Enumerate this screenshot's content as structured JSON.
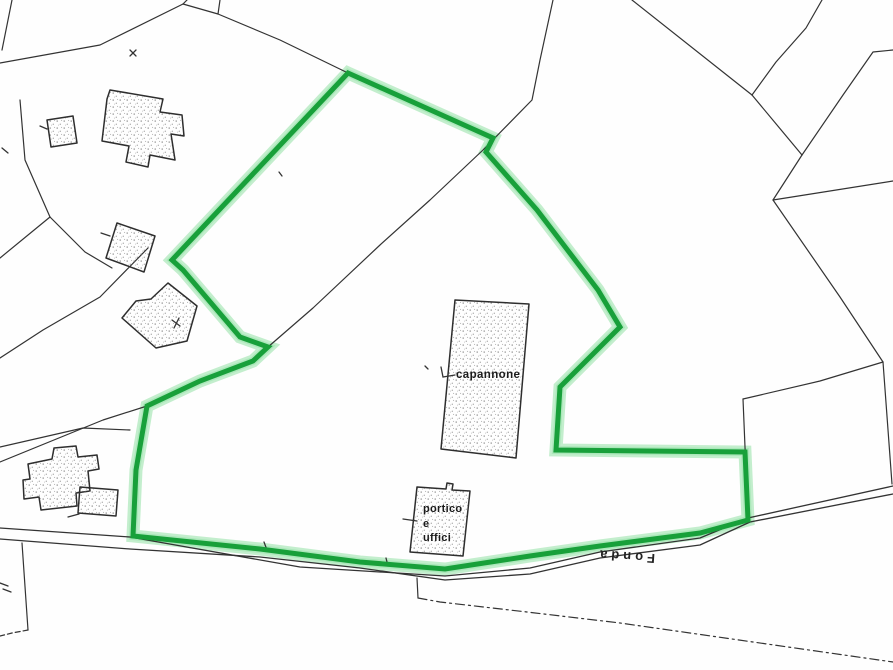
{
  "map": {
    "type": "cadastral-plan",
    "background": "#fefefe",
    "colors": {
      "highlight_green": "#18a03a",
      "highlight_glow": "#bcecc8",
      "highlight_glow_mid": "#8fdfa4",
      "parcel_line": "#333333",
      "building_outline": "#2e2e2e",
      "stipple_dot": "#777777"
    },
    "labels": {
      "capannone": {
        "text": "capannone",
        "x": 457,
        "y": 372
      },
      "portico": {
        "lines": [
          "portico",
          "e",
          "uffici"
        ],
        "x": 424,
        "y": 505
      },
      "fonda": {
        "text": "Fonda",
        "x": 624,
        "y": 560,
        "rotation_deg": 184
      }
    },
    "highlight_boundary": {
      "closed": true,
      "points": [
        [
          348,
          73
        ],
        [
          493,
          138
        ],
        [
          486,
          152
        ],
        [
          537,
          210
        ],
        [
          598,
          290
        ],
        [
          620,
          327
        ],
        [
          560,
          387
        ],
        [
          556,
          450
        ],
        [
          745,
          452
        ],
        [
          748,
          520
        ],
        [
          700,
          533
        ],
        [
          600,
          546
        ],
        [
          530,
          556
        ],
        [
          445,
          569
        ],
        [
          360,
          562
        ],
        [
          260,
          549
        ],
        [
          133,
          536
        ],
        [
          136,
          470
        ],
        [
          147,
          406
        ],
        [
          200,
          381
        ],
        [
          253,
          361
        ],
        [
          268,
          347
        ],
        [
          240,
          337
        ],
        [
          183,
          270
        ],
        [
          172,
          260
        ]
      ]
    },
    "parcel_lines": [
      {
        "pts": [
          [
            12,
            0
          ],
          [
            2,
            50
          ]
        ]
      },
      {
        "pts": [
          [
            187,
            0
          ],
          [
            183,
            4
          ]
        ]
      },
      {
        "pts": [
          [
            183,
            4
          ],
          [
            100,
            45
          ],
          [
            0,
            63
          ]
        ]
      },
      {
        "pts": [
          [
            220,
            0
          ],
          [
            218,
            14
          ]
        ]
      },
      {
        "pts": [
          [
            183,
            4
          ],
          [
            218,
            14
          ],
          [
            280,
            40
          ],
          [
            348,
            73
          ]
        ]
      },
      {
        "pts": [
          [
            553,
            0
          ],
          [
            540,
            60
          ],
          [
            532,
            100
          ],
          [
            483,
            150
          ],
          [
            430,
            200
          ],
          [
            380,
            245
          ],
          [
            313,
            308
          ],
          [
            268,
            347
          ]
        ]
      },
      {
        "pts": [
          [
            632,
            0
          ],
          [
            752,
            95
          ]
        ]
      },
      {
        "pts": [
          [
            822,
            0
          ],
          [
            806,
            28
          ],
          [
            776,
            62
          ],
          [
            752,
            95
          ]
        ]
      },
      {
        "pts": [
          [
            752,
            95
          ],
          [
            802,
            155
          ]
        ]
      },
      {
        "pts": [
          [
            893,
            50
          ],
          [
            873,
            52
          ],
          [
            843,
            95
          ],
          [
            802,
            155
          ]
        ]
      },
      {
        "pts": [
          [
            802,
            155
          ],
          [
            773,
            200
          ]
        ]
      },
      {
        "pts": [
          [
            773,
            200
          ],
          [
            893,
            181
          ]
        ]
      },
      {
        "pts": [
          [
            773,
            200
          ],
          [
            840,
            297
          ],
          [
            883,
            362
          ]
        ]
      },
      {
        "pts": [
          [
            883,
            362
          ],
          [
            892,
            484
          ]
        ]
      },
      {
        "pts": [
          [
            883,
            362
          ],
          [
            820,
            381
          ],
          [
            743,
            399
          ]
        ]
      },
      {
        "pts": [
          [
            743,
            399
          ],
          [
            748,
            519
          ]
        ]
      },
      {
        "pts": [
          [
            0,
            528
          ],
          [
            130,
            537
          ],
          [
            300,
            567
          ],
          [
            445,
            576
          ],
          [
            530,
            568
          ],
          [
            600,
            552
          ],
          [
            700,
            538
          ],
          [
            748,
            518
          ],
          [
            893,
            486
          ]
        ],
        "w": 1.3
      },
      {
        "pts": [
          [
            0,
            539
          ],
          [
            130,
            549
          ],
          [
            260,
            557
          ],
          [
            360,
            568
          ],
          [
            445,
            580
          ],
          [
            530,
            574
          ],
          [
            600,
            558
          ],
          [
            700,
            545
          ],
          [
            750,
            522
          ],
          [
            893,
            494
          ]
        ],
        "w": 1.3
      },
      {
        "pts": [
          [
            417,
            578
          ],
          [
            418,
            598
          ]
        ]
      },
      {
        "pts": [
          [
            418,
            598
          ],
          [
            440,
            602
          ],
          [
            527,
            612
          ],
          [
            620,
            623
          ],
          [
            893,
            662
          ]
        ],
        "dash": "9 4 2 4"
      },
      {
        "pts": [
          [
            22,
            543
          ],
          [
            28,
            630
          ]
        ]
      },
      {
        "pts": [
          [
            28,
            630
          ],
          [
            12,
            633
          ],
          [
            0,
            636
          ]
        ],
        "dash": "5 3"
      },
      {
        "pts": [
          [
            20,
            100
          ],
          [
            25,
            160
          ],
          [
            50,
            217
          ]
        ]
      },
      {
        "pts": [
          [
            50,
            217
          ],
          [
            0,
            258
          ]
        ]
      },
      {
        "pts": [
          [
            50,
            217
          ],
          [
            85,
            252
          ],
          [
            112,
            268
          ]
        ]
      },
      {
        "pts": [
          [
            148,
            248
          ],
          [
            100,
            297
          ],
          [
            43,
            330
          ],
          [
            0,
            358
          ]
        ]
      },
      {
        "pts": [
          [
            147,
            406
          ],
          [
            103,
            420
          ],
          [
            0,
            462
          ]
        ]
      },
      {
        "pts": [
          [
            130,
            430
          ],
          [
            83,
            428
          ],
          [
            0,
            447
          ]
        ]
      },
      {
        "pts": [
          [
            147,
            405
          ],
          [
            200,
            380
          ],
          [
            253,
            360
          ],
          [
            268,
            347
          ]
        ]
      }
    ],
    "buildings": [
      {
        "name": "building-small-nw",
        "pts": [
          [
            47,
            120
          ],
          [
            73,
            116
          ],
          [
            77,
            143
          ],
          [
            51,
            147
          ]
        ]
      },
      {
        "name": "building-farmhouse-nw",
        "pts": [
          [
            110,
            90
          ],
          [
            163,
            99
          ],
          [
            160,
            112
          ],
          [
            182,
            115
          ],
          [
            184,
            136
          ],
          [
            171,
            134
          ],
          [
            175,
            160
          ],
          [
            150,
            155
          ],
          [
            148,
            167
          ],
          [
            126,
            162
          ],
          [
            129,
            146
          ],
          [
            102,
            141
          ],
          [
            107,
            99
          ]
        ]
      },
      {
        "name": "building-mid-west-a",
        "pts": [
          [
            117,
            223
          ],
          [
            155,
            236
          ],
          [
            144,
            272
          ],
          [
            106,
            258
          ]
        ]
      },
      {
        "name": "building-mid-west-b",
        "pts": [
          [
            168,
            283
          ],
          [
            197,
            306
          ],
          [
            187,
            341
          ],
          [
            156,
            348
          ],
          [
            122,
            318
          ],
          [
            136,
            301
          ],
          [
            151,
            299
          ]
        ]
      },
      {
        "name": "building-sw-large",
        "pts": [
          [
            28,
            464
          ],
          [
            52,
            459
          ],
          [
            54,
            448
          ],
          [
            76,
            446
          ],
          [
            78,
            457
          ],
          [
            97,
            455
          ],
          [
            99,
            469
          ],
          [
            88,
            471
          ],
          [
            90,
            491
          ],
          [
            76,
            493
          ],
          [
            77,
            506
          ],
          [
            41,
            510
          ],
          [
            39,
            497
          ],
          [
            24,
            499
          ],
          [
            23,
            480
          ],
          [
            30,
            479
          ]
        ]
      },
      {
        "name": "building-sw-small",
        "pts": [
          [
            80,
            487
          ],
          [
            118,
            490
          ],
          [
            116,
            516
          ],
          [
            78,
            513
          ]
        ]
      },
      {
        "name": "building-capannone",
        "pts": [
          [
            455,
            300
          ],
          [
            529,
            304
          ],
          [
            516,
            458
          ],
          [
            441,
            449
          ]
        ]
      },
      {
        "name": "building-portico-uffici",
        "pts": [
          [
            417,
            487
          ],
          [
            446,
            489
          ],
          [
            447,
            483
          ],
          [
            453,
            484
          ],
          [
            452,
            490
          ],
          [
            470,
            491
          ],
          [
            463,
            556
          ],
          [
            410,
            552
          ]
        ]
      }
    ],
    "ticks": [
      {
        "pts": [
          [
            40,
            126
          ],
          [
            47,
            129
          ]
        ]
      },
      {
        "pts": [
          [
            101,
            233
          ],
          [
            110,
            236
          ]
        ]
      },
      {
        "pts": [
          [
            172,
            320
          ],
          [
            180,
            326
          ]
        ]
      },
      {
        "pts": [
          [
            179,
            318
          ],
          [
            174,
            328
          ]
        ]
      },
      {
        "pts": [
          [
            441,
            367
          ],
          [
            443,
            377
          ],
          [
            455,
            375
          ]
        ]
      },
      {
        "pts": [
          [
            403,
            519
          ],
          [
            417,
            521
          ]
        ]
      },
      {
        "pts": [
          [
            68,
            517
          ],
          [
            79,
            514
          ]
        ]
      },
      {
        "pts": [
          [
            264,
            542
          ],
          [
            267,
            550
          ]
        ]
      },
      {
        "pts": [
          [
            386,
            558
          ],
          [
            388,
            566
          ]
        ]
      },
      {
        "pts": [
          [
            0,
            583
          ],
          [
            8,
            586
          ]
        ]
      },
      {
        "pts": [
          [
            3,
            589
          ],
          [
            11,
            592
          ]
        ]
      },
      {
        "pts": [
          [
            2,
            148
          ],
          [
            8,
            153
          ]
        ]
      },
      {
        "pts": [
          [
            130,
            50
          ],
          [
            136,
            56
          ]
        ]
      },
      {
        "pts": [
          [
            136,
            50
          ],
          [
            130,
            56
          ]
        ]
      },
      {
        "pts": [
          [
            279,
            172
          ],
          [
            282,
            176
          ]
        ]
      },
      {
        "pts": [
          [
            425,
            366
          ],
          [
            428,
            369
          ]
        ]
      }
    ]
  }
}
